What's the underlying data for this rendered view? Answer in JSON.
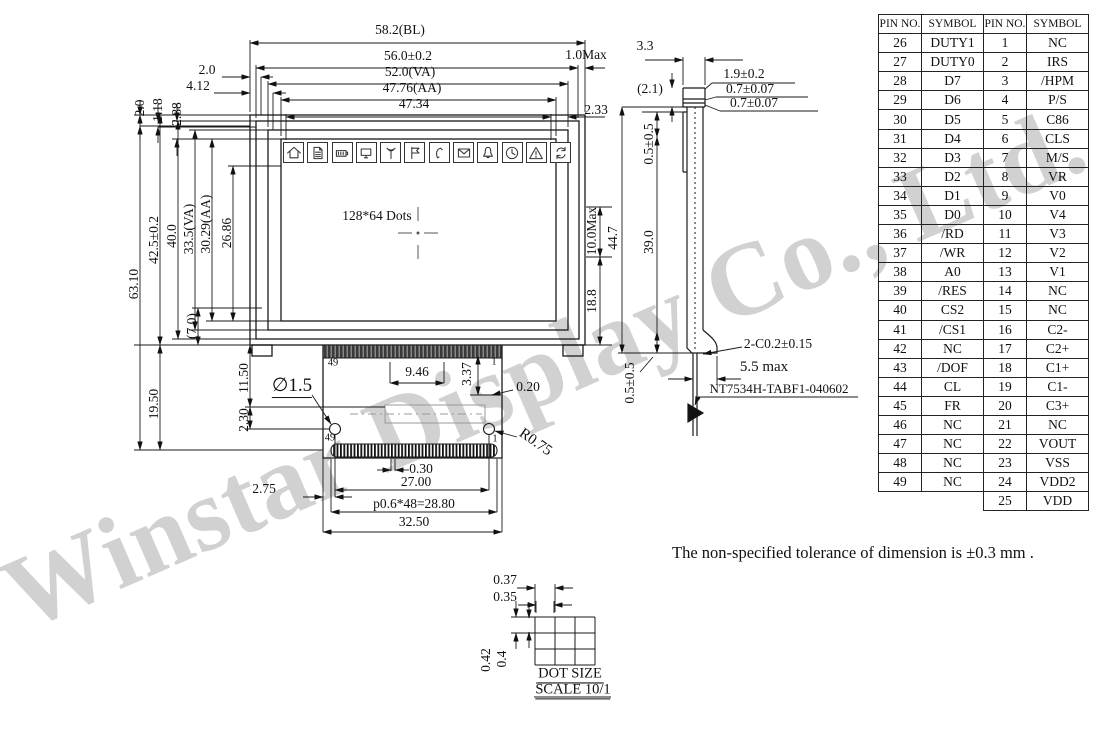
{
  "watermark": {
    "text": "Winstar Display Co., Ltd."
  },
  "note": {
    "text": "The non-specified tolerance of dimension is ±0.3 mm ."
  },
  "display": {
    "dots_label": "128*64 Dots",
    "icons": [
      "home-icon",
      "document-icon",
      "battery-icon",
      "monitor-icon",
      "antenna-icon",
      "flag-icon",
      "phone-icon",
      "mail-icon",
      "bell-icon",
      "clock-icon",
      "warning-icon",
      "refresh-icon"
    ]
  },
  "pin_table": {
    "headers": [
      "PIN NO.",
      "SYMBOL",
      "PIN NO.",
      "SYMBOL"
    ],
    "rows": [
      [
        "26",
        "DUTY1",
        "1",
        "NC"
      ],
      [
        "27",
        "DUTY0",
        "2",
        "IRS"
      ],
      [
        "28",
        "D7",
        "3",
        "/HPM"
      ],
      [
        "29",
        "D6",
        "4",
        "P/S"
      ],
      [
        "30",
        "D5",
        "5",
        "C86"
      ],
      [
        "31",
        "D4",
        "6",
        "CLS"
      ],
      [
        "32",
        "D3",
        "7",
        "M/S"
      ],
      [
        "33",
        "D2",
        "8",
        "VR"
      ],
      [
        "34",
        "D1",
        "9",
        "V0"
      ],
      [
        "35",
        "D0",
        "10",
        "V4"
      ],
      [
        "36",
        "/RD",
        "11",
        "V3"
      ],
      [
        "37",
        "/WR",
        "12",
        "V2"
      ],
      [
        "38",
        "A0",
        "13",
        "V1"
      ],
      [
        "39",
        "/RES",
        "14",
        "NC"
      ],
      [
        "40",
        "CS2",
        "15",
        "NC"
      ],
      [
        "41",
        "/CS1",
        "16",
        "C2-"
      ],
      [
        "42",
        "NC",
        "17",
        "C2+"
      ],
      [
        "43",
        "/DOF",
        "18",
        "C1+"
      ],
      [
        "44",
        "CL",
        "19",
        "C1-"
      ],
      [
        "45",
        "FR",
        "20",
        "C3+"
      ],
      [
        "46",
        "NC",
        "21",
        "NC"
      ],
      [
        "47",
        "NC",
        "22",
        "VOUT"
      ],
      [
        "48",
        "NC",
        "23",
        "VSS"
      ],
      [
        "49",
        "NC",
        "24",
        "VDD2"
      ],
      [
        "",
        "",
        "25",
        "VDD"
      ]
    ]
  },
  "annotations": [
    {
      "n": "dim-bl-width",
      "t": "58.2(BL)",
      "x": 400,
      "y": 30
    },
    {
      "n": "dim-outline-width",
      "t": "56.0±0.2",
      "x": 408,
      "y": 56
    },
    {
      "n": "dim-right-offset-max",
      "t": "1.0Max",
      "x": 586,
      "y": 55
    },
    {
      "n": "dim-va-width",
      "t": "52.0(VA)",
      "x": 410,
      "y": 72
    },
    {
      "n": "dim-aa-width",
      "t": "47.76(AA)",
      "x": 412,
      "y": 88
    },
    {
      "n": "dim-icon-row-width",
      "t": "47.34",
      "x": 414,
      "y": 104
    },
    {
      "n": "dim-right-inset",
      "t": "2.33",
      "x": 596,
      "y": 110
    },
    {
      "n": "dim-left-offset-a",
      "t": "2.0",
      "x": 207,
      "y": 70
    },
    {
      "n": "dim-left-offset-b",
      "t": "4.12",
      "x": 198,
      "y": 86
    },
    {
      "n": "dim-top-offset-a",
      "t": "2.0",
      "x": 140,
      "y": 108,
      "r": -90
    },
    {
      "n": "dim-top-offset-b",
      "t": "1.18",
      "x": 158,
      "y": 110,
      "r": -90
    },
    {
      "n": "dim-top-offset-c",
      "t": "2.88",
      "x": 177,
      "y": 114,
      "r": -90
    },
    {
      "n": "dim-total-height",
      "t": "63.10",
      "x": 134,
      "y": 284,
      "r": -90
    },
    {
      "n": "dim-module-height",
      "t": "42.5±0.2",
      "x": 154,
      "y": 240,
      "r": -90
    },
    {
      "n": "dim-frame-height",
      "t": "40.0",
      "x": 172,
      "y": 236,
      "r": -90
    },
    {
      "n": "dim-va-height",
      "t": "33.5(VA)",
      "x": 189,
      "y": 229,
      "r": -90
    },
    {
      "n": "dim-aa-height",
      "t": "30.29(AA)",
      "x": 206,
      "y": 224,
      "r": -90
    },
    {
      "n": "dim-display-height",
      "t": "26.86",
      "x": 227,
      "y": 233,
      "r": -90
    },
    {
      "n": "dim-bottom-bezel",
      "t": "(7.0)",
      "x": 192,
      "y": 326,
      "r": -90
    },
    {
      "n": "dim-tail-height",
      "t": "19.50",
      "x": 154,
      "y": 404,
      "r": -90
    },
    {
      "n": "dim-hole-offset-y1",
      "t": "11.50",
      "x": 244,
      "y": 378,
      "r": -90
    },
    {
      "n": "dim-hole-offset-y2",
      "t": "2.30",
      "x": 244,
      "y": 420,
      "r": -90
    },
    {
      "n": "pin-49-top-label",
      "t": "49",
      "x": 333,
      "y": 363,
      "s": 10.5
    },
    {
      "n": "pin-1-top-label",
      "t": "1",
      "x": 494,
      "y": 362,
      "s": 10.5
    },
    {
      "n": "dim-hole-diameter",
      "t": "∅1.5",
      "x": 292,
      "y": 387,
      "s": 19,
      "u": 1
    },
    {
      "n": "dim-tail-a",
      "t": "9.46",
      "x": 417,
      "y": 372
    },
    {
      "n": "dim-tail-b",
      "t": "3.37",
      "x": 467,
      "y": 374,
      "r": -90
    },
    {
      "n": "dim-tail-c",
      "t": "0.20",
      "x": 528,
      "y": 387
    },
    {
      "n": "pin-49-bottom-label",
      "t": "49",
      "x": 330,
      "y": 438,
      "s": 10.5
    },
    {
      "n": "pin-1-bottom-label",
      "t": "1",
      "x": 495,
      "y": 439,
      "s": 10.5
    },
    {
      "n": "dim-hole-radius",
      "t": "R0.75",
      "x": 535,
      "y": 443,
      "r": 35,
      "s": 15
    },
    {
      "n": "dim-pin-width",
      "t": "0.30",
      "x": 421,
      "y": 469
    },
    {
      "n": "dim-pin-margin",
      "t": "2.75",
      "x": 264,
      "y": 489
    },
    {
      "n": "dim-hole-span",
      "t": "27.00",
      "x": 416,
      "y": 482
    },
    {
      "n": "dim-pin-pitch",
      "t": "p0.6*48=28.80",
      "x": 414,
      "y": 504
    },
    {
      "n": "dim-tail-width",
      "t": "32.50",
      "x": 414,
      "y": 522
    },
    {
      "n": "dim-side-top-width",
      "t": "3.3",
      "x": 645,
      "y": 46
    },
    {
      "n": "dim-side-stack",
      "t": "(2.1)",
      "x": 650,
      "y": 89
    },
    {
      "n": "dim-glass-a",
      "t": "1.9±0.2",
      "x": 744,
      "y": 74
    },
    {
      "n": "dim-glass-b",
      "t": "0.7±0.07",
      "x": 750,
      "y": 89
    },
    {
      "n": "dim-glass-c",
      "t": "0.7±0.07",
      "x": 754,
      "y": 103
    },
    {
      "n": "dim-side-gap-top",
      "t": "0.5±0.5",
      "x": 649,
      "y": 144,
      "r": -90
    },
    {
      "n": "dim-side-body",
      "t": "39.0",
      "x": 649,
      "y": 242,
      "r": -90
    },
    {
      "n": "dim-side-total",
      "t": "44.7",
      "x": 613,
      "y": 238,
      "r": -90
    },
    {
      "n": "dim-side-ic-max",
      "t": "10.0Max",
      "x": 592,
      "y": 231,
      "r": -90
    },
    {
      "n": "dim-side-lower",
      "t": "18.8",
      "x": 592,
      "y": 301,
      "r": -90
    },
    {
      "n": "dim-side-gap-bottom",
      "t": "0.5±0.5",
      "x": 630,
      "y": 383,
      "r": -90
    },
    {
      "n": "dim-chamfer",
      "t": "2-C0.2±0.15",
      "x": 778,
      "y": 344
    },
    {
      "n": "dim-foot-max",
      "t": "5.5 max",
      "x": 764,
      "y": 368,
      "s": 15
    },
    {
      "n": "part-number",
      "t": "NT7534H-TABF1-040602",
      "x": 779,
      "y": 389,
      "s": 13
    },
    {
      "n": "dim-dot-pitch-x",
      "t": "0.37",
      "x": 505,
      "y": 580
    },
    {
      "n": "dim-dot-width",
      "t": "0.35",
      "x": 505,
      "y": 597
    },
    {
      "n": "dim-dot-pitch-y",
      "t": "0.42",
      "x": 486,
      "y": 660,
      "r": -90
    },
    {
      "n": "dim-dot-height",
      "t": "0.4",
      "x": 502,
      "y": 659,
      "r": -90
    },
    {
      "n": "detail-title",
      "t": "DOT SIZE",
      "x": 570,
      "y": 675,
      "u": 1,
      "s": 14.5
    },
    {
      "n": "detail-scale",
      "t": "SCALE 10/1",
      "x": 573,
      "y": 691,
      "u": 1,
      "s": 14.5
    },
    {
      "n": "display-dots-label",
      "t": "128*64 Dots",
      "x": 377,
      "y": 216
    }
  ]
}
